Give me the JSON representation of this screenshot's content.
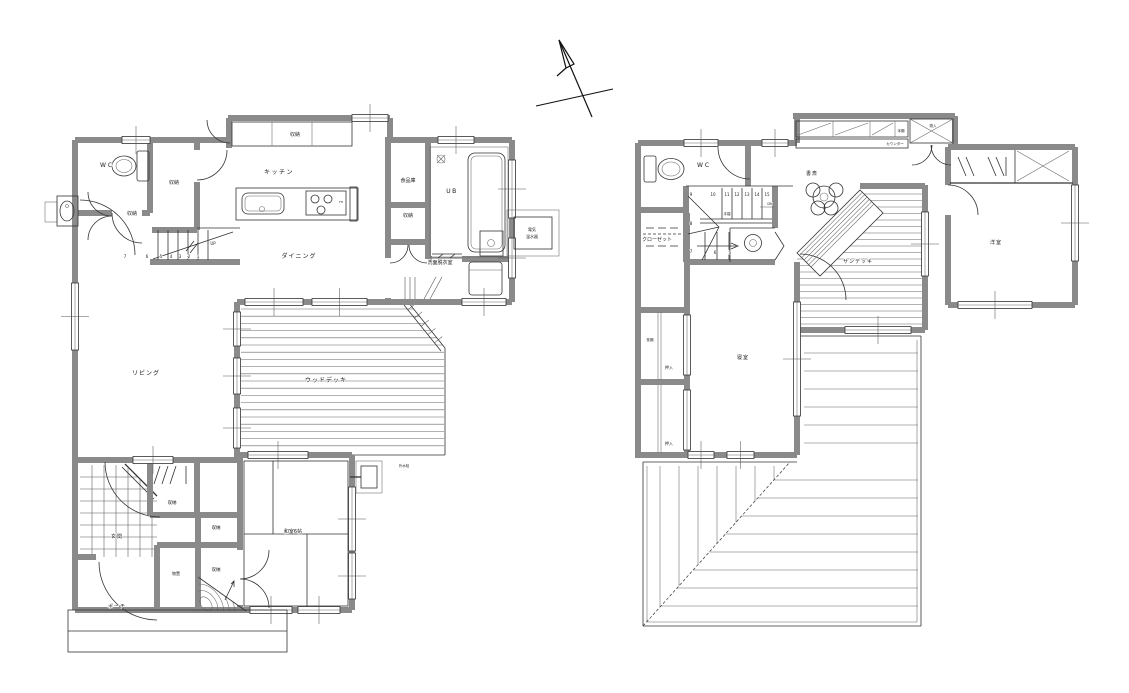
{
  "document": {
    "type": "architectural-floor-plan",
    "floors": [
      "1F",
      "2F"
    ]
  },
  "colors": {
    "wall": "#8a8a8a",
    "line": "#333333",
    "background": "#ffffff"
  },
  "floor1": {
    "labels": [
      {
        "id": "wc",
        "t": "WC",
        "x": 107,
        "y": 167,
        "s": 6,
        "ls": 2
      },
      {
        "id": "storage-by-wc",
        "t": "収納",
        "x": 174,
        "y": 184,
        "s": 5
      },
      {
        "id": "storage-hall",
        "t": "収納",
        "x": 132,
        "y": 215,
        "s": 5
      },
      {
        "id": "kitchen",
        "t": "キッチン",
        "x": 279,
        "y": 174,
        "s": 6,
        "ls": 1.5
      },
      {
        "id": "storage-kitchen",
        "t": "収納",
        "x": 295,
        "y": 136,
        "s": 5
      },
      {
        "id": "pantry",
        "t": "食品庫",
        "x": 408,
        "y": 182,
        "s": 5
      },
      {
        "id": "unit-bath",
        "t": "UB",
        "x": 452,
        "y": 193,
        "s": 6,
        "ls": 1.5
      },
      {
        "id": "storage-pantry",
        "t": "収納",
        "x": 408,
        "y": 217,
        "s": 5
      },
      {
        "id": "dining",
        "t": "ダイニング",
        "x": 299,
        "y": 258,
        "s": 6,
        "ls": 1
      },
      {
        "id": "stair-up",
        "t": "UP",
        "x": 213,
        "y": 245,
        "s": 4
      },
      {
        "id": "sn7",
        "t": "7",
        "x": 125,
        "y": 258,
        "s": 4
      },
      {
        "id": "sn6",
        "t": "6",
        "x": 147,
        "y": 258,
        "s": 4
      },
      {
        "id": "sn5",
        "t": "5",
        "x": 161,
        "y": 258,
        "s": 4
      },
      {
        "id": "sn4",
        "t": "4",
        "x": 171,
        "y": 258,
        "s": 4
      },
      {
        "id": "sn3",
        "t": "3",
        "x": 180,
        "y": 258,
        "s": 4
      },
      {
        "id": "sn2",
        "t": "2",
        "x": 189,
        "y": 258,
        "s": 4
      },
      {
        "id": "sn1",
        "t": "1",
        "x": 198,
        "y": 258,
        "s": 4
      },
      {
        "id": "washroom",
        "t": "洗面脱衣室",
        "x": 440,
        "y": 264,
        "s": 5
      },
      {
        "id": "water-heater-1",
        "t": "電気",
        "x": 532,
        "y": 231,
        "s": 4
      },
      {
        "id": "water-heater-2",
        "t": "温水器",
        "x": 532,
        "y": 238,
        "s": 4
      },
      {
        "id": "living",
        "t": "リビング",
        "x": 146,
        "y": 375,
        "s": 6,
        "ls": 1
      },
      {
        "id": "wood-deck",
        "t": "ウッドデッキ",
        "x": 326,
        "y": 382,
        "s": 6,
        "ls": 1
      },
      {
        "id": "genkan",
        "t": "玄関",
        "x": 117,
        "y": 538,
        "s": 5,
        "ls": 1
      },
      {
        "id": "storage-hall2",
        "t": "収納",
        "x": 172,
        "y": 504,
        "s": 4.5
      },
      {
        "id": "storage-mid",
        "t": "収納",
        "x": 216,
        "y": 529,
        "s": 4.5
      },
      {
        "id": "storage-low",
        "t": "収納",
        "x": 216,
        "y": 571,
        "s": 4.5
      },
      {
        "id": "monooki",
        "t": "物置",
        "x": 176,
        "y": 575,
        "s": 4
      },
      {
        "id": "washitsu",
        "t": "和室6帖",
        "x": 293,
        "y": 533,
        "s": 5
      },
      {
        "id": "porch",
        "t": "ポーチ",
        "x": 117,
        "y": 608,
        "s": 5,
        "ls": 1
      },
      {
        "id": "outdoor-tap",
        "t": "外水栓",
        "x": 404,
        "y": 467,
        "s": 3.5
      },
      {
        "id": "fh",
        "t": "FH",
        "x": 341,
        "y": 203,
        "s": 3
      }
    ]
  },
  "floor2": {
    "labels": [
      {
        "id": "wc",
        "t": "WC",
        "x": 704,
        "y": 167,
        "s": 6,
        "ls": 2
      },
      {
        "id": "closet",
        "t": "クローゼット",
        "x": 657,
        "y": 241,
        "s": 5
      },
      {
        "id": "study",
        "t": "書斎",
        "x": 812,
        "y": 175,
        "s": 5,
        "ls": 1
      },
      {
        "id": "sun-deck",
        "t": "サンデッキ",
        "x": 858,
        "y": 263,
        "s": 5,
        "ls": 1
      },
      {
        "id": "western-room",
        "t": "洋室",
        "x": 996,
        "y": 244,
        "s": 5,
        "ls": 1
      },
      {
        "id": "bedroom",
        "t": "寝室",
        "x": 743,
        "y": 359,
        "s": 5,
        "ls": 1
      },
      {
        "id": "makuradana",
        "t": "枕棚",
        "x": 650,
        "y": 341,
        "s": 3.5
      },
      {
        "id": "oshiire-1",
        "t": "押入",
        "x": 669,
        "y": 369,
        "s": 4
      },
      {
        "id": "oshiire-2",
        "t": "押入",
        "x": 669,
        "y": 445,
        "s": 4
      },
      {
        "id": "bookshelf",
        "t": "本棚",
        "x": 901,
        "y": 132,
        "s": 3.5
      },
      {
        "id": "counter",
        "t": "カウンター",
        "x": 895,
        "y": 145,
        "s": 3.5
      },
      {
        "id": "storage-box",
        "t": "物入",
        "x": 933,
        "y": 127,
        "s": 3.5
      },
      {
        "id": "handrail",
        "t": "手摺",
        "x": 727,
        "y": 215,
        "s": 3.5
      },
      {
        "id": "stair-dn",
        "t": "DN",
        "x": 770,
        "y": 205,
        "s": 3.5
      },
      {
        "id": "sn9",
        "t": "9",
        "x": 691,
        "y": 196,
        "s": 4
      },
      {
        "id": "sn10",
        "t": "10",
        "x": 713,
        "y": 196,
        "s": 4
      },
      {
        "id": "sn11",
        "t": "11",
        "x": 727,
        "y": 196,
        "s": 4
      },
      {
        "id": "sn12",
        "t": "12",
        "x": 737,
        "y": 196,
        "s": 4
      },
      {
        "id": "sn13",
        "t": "13",
        "x": 747,
        "y": 196,
        "s": 4
      },
      {
        "id": "sn14",
        "t": "14",
        "x": 757,
        "y": 196,
        "s": 4
      },
      {
        "id": "sn15",
        "t": "15",
        "x": 767,
        "y": 196,
        "s": 4
      },
      {
        "id": "sn8",
        "t": "8",
        "x": 691,
        "y": 225,
        "s": 4
      },
      {
        "id": "sn7b",
        "t": "7",
        "x": 691,
        "y": 253,
        "s": 4
      },
      {
        "id": "sn6b",
        "t": "6",
        "x": 715,
        "y": 254,
        "s": 4
      },
      {
        "id": "sn5b",
        "t": "5",
        "x": 730,
        "y": 254,
        "s": 4
      }
    ]
  }
}
